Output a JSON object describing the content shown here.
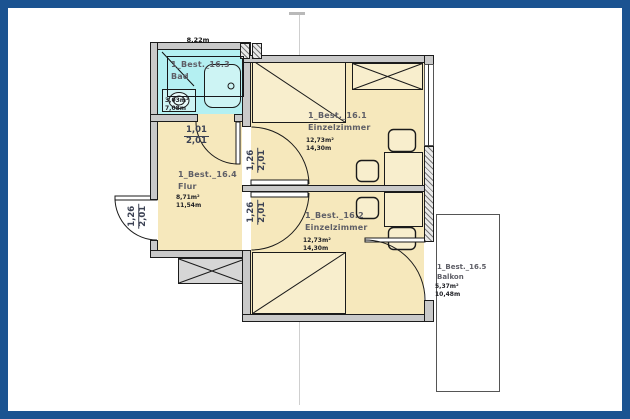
{
  "rooms": [
    {
      "id": "1_Best._16.1",
      "name": "Einzelzimmer",
      "area": "12,73m²",
      "perimeter": "14,30m"
    },
    {
      "id": "1_Best._16.2",
      "name": "Einzelzimmer",
      "area": "12,73m²",
      "perimeter": "14,30m"
    },
    {
      "id": "1_Best._16.3",
      "name": "Bad",
      "area": "3,03m²",
      "perimeter": "7,08m"
    },
    {
      "id": "1_Best._16.4",
      "name": "Flur",
      "area": "8,71m²",
      "perimeter": "11,54m"
    },
    {
      "id": "1_Best._16.5",
      "name": "Balkon",
      "area": "5,37m²",
      "perimeter": "10,48m"
    }
  ],
  "dimensions": {
    "top_width": "8,22m",
    "doors": {
      "bad": {
        "width": "1,01",
        "height": "2,01"
      },
      "entry": {
        "width": "1,26",
        "height": "2,01"
      },
      "room1": {
        "width": "1,26",
        "height": "2,01"
      },
      "room2": {
        "width": "1,26",
        "height": "2,01"
      }
    }
  },
  "colors": {
    "frame": "#1b5391",
    "room_fill": "#f6e8bc",
    "bath_fill": "#b4f0f2",
    "wall_fill": "#c9c9c9",
    "balcony_fill": "#ffffff"
  }
}
